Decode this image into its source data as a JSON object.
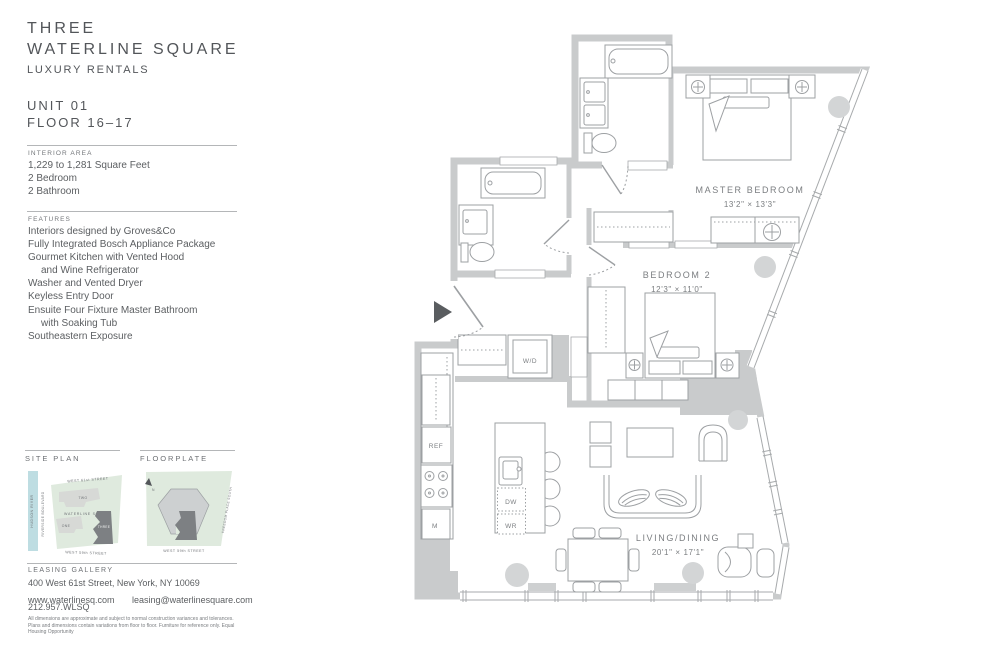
{
  "brand": {
    "line1": "THREE",
    "line2": "WATERLINE SQUARE",
    "line3": "LUXURY RENTALS"
  },
  "unit": {
    "number": "UNIT 01",
    "floor": "FLOOR 16–17"
  },
  "interior_area": {
    "heading": "INTERIOR AREA",
    "lines": [
      "1,229 to 1,281 Square Feet",
      "2 Bedroom",
      "2 Bathroom"
    ]
  },
  "features": {
    "heading": "FEATURES",
    "lines": [
      "Interiors designed by Groves&Co",
      "Fully Integrated Bosch Appliance Package",
      "Gourmet Kitchen with Vented Hood",
      "and Wine Refrigerator",
      "Washer and Vented Dryer",
      "Keyless Entry Door",
      "Ensuite Four Fixture Master Bathroom",
      "with Soaking Tub",
      "Southeastern Exposure"
    ]
  },
  "site_plan": {
    "heading": "SITE PLAN",
    "west_61": "WEST 61st STREET",
    "west_59": "WEST 59th STREET",
    "hudson": "HUDSON RIVER",
    "riverside": "RIVERSIDE BOULEVARD",
    "square": "WATERLINE SQUARE",
    "one": "ONE",
    "two": "TWO",
    "three": "THREE"
  },
  "floorplate": {
    "heading": "FLOORPLATE",
    "west_59": "WEST 59th STREET",
    "freedom": "FREEDOM PLACE SOUTH",
    "north": "N"
  },
  "leasing": {
    "heading": "LEASING GALLERY",
    "address": "400 West 61st Street, New York, NY 10069",
    "website": "www.waterlinesq.com",
    "email": "leasing@waterlinesquare.com",
    "phone": "212.957.WLSQ"
  },
  "disclaimer": "All dimensions are approximate and subject to normal construction variances and tolerances. Plans and dimensions contain variations from floor to floor. Furniture for reference only. Equal Housing Opportunity",
  "floor_plan": {
    "rooms": [
      {
        "name": "MASTER BEDROOM",
        "dims": "13'2\" × 13'3\""
      },
      {
        "name": "BEDROOM 2",
        "dims": "12'3\" × 11'0\""
      },
      {
        "name": "LIVING/DINING",
        "dims": "20'1\" × 17'1\""
      }
    ],
    "labels": {
      "washer_dryer": "W/D",
      "refrigerator": "REF",
      "dishwasher": "DW",
      "wine_refrigerator": "WR",
      "microwave": "M"
    }
  },
  "colors": {
    "wall": "#c9cbcc",
    "accent_green": "#dfeade",
    "accent_blue": "#bedde2",
    "dark_building": "#7d8083"
  }
}
